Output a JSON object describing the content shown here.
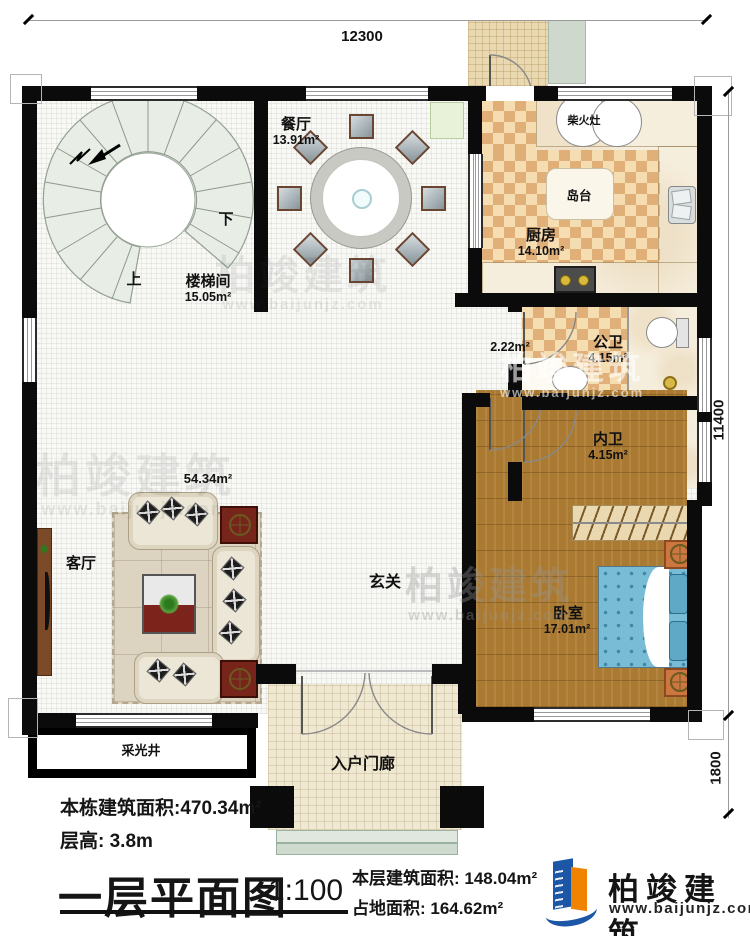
{
  "plan": {
    "dimensions": {
      "top": "12300",
      "right_upper": "11400",
      "right_lower": "1800"
    },
    "rooms": {
      "dining": {
        "name": "餐厅",
        "area": "13.91m²"
      },
      "kitchen": {
        "name": "厨房",
        "area": "14.10m²"
      },
      "island": {
        "name": "岛台"
      },
      "wood_stove": {
        "name": "柴火灶"
      },
      "stairwell": {
        "name": "楼梯间",
        "area": "15.05m²",
        "up": "上",
        "down": "下"
      },
      "corridor": {
        "area": "2.22m²"
      },
      "public_bath": {
        "name": "公卫",
        "area": "4.15m²"
      },
      "inner_bath": {
        "name": "内卫",
        "area": "4.15m²"
      },
      "bedroom": {
        "name": "卧室",
        "area": "17.01m²"
      },
      "living": {
        "name": "客厅",
        "area": "54.34m²"
      },
      "foyer": {
        "name": "玄关"
      },
      "entry_porch": {
        "name": "入户门廊"
      },
      "light_well": {
        "name": "采光井"
      }
    }
  },
  "title_block": {
    "building_total_area_label": "本栋建筑面积:470.34m²",
    "floor_height_label": "层高: 3.8m",
    "drawing_title": "一层平面图",
    "scale": "1:100",
    "floor_area_label": "本层建筑面积: 148.04m²",
    "footprint_label": "占地面积: 164.62m²"
  },
  "brand": {
    "logo_text": "柏竣建筑",
    "website": "www.baijunjz.com"
  },
  "watermark": {
    "text": "柏竣建筑",
    "website": "www.baijunjz.com"
  },
  "colors": {
    "wall": "#0b0b0b",
    "checker_dark": "#e0ad74",
    "checker_light": "#f6ddb0",
    "wood_floor": "#aa7a33",
    "bed_blue": "#79bcd6",
    "logo_blue": "#1b57a6",
    "logo_orange": "#f08300"
  }
}
